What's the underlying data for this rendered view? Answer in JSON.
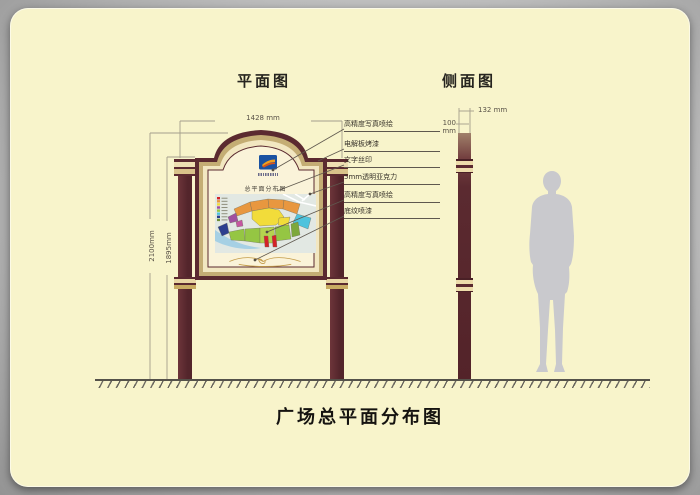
{
  "front_view": {
    "title": "平面图",
    "dim_width": "1428 mm",
    "dim_total_height": "2100mm",
    "dim_post_height": "1895mm",
    "panel_subtitle": "总平面分布图",
    "callouts": [
      {
        "label": "高精度写真喷绘"
      },
      {
        "label": "电解板烤漆"
      },
      {
        "label": "文字丝印"
      },
      {
        "label": "5mm透明亚克力"
      },
      {
        "label": "高精度写真喷绘"
      },
      {
        "label": "底纹喷漆"
      }
    ]
  },
  "side_view": {
    "title": "侧面图",
    "dim_depth": "132 mm",
    "dim_width": "100 mm"
  },
  "footer": {
    "title": "广场总平面分布图"
  },
  "colors": {
    "card_bg": "#f8f4cb",
    "maroon": "#5b2a30",
    "frame_tan": "#c4ad74",
    "frame_cream": "#f2e7c1",
    "panel_bg": "#faf3d9",
    "gold_band": "#d9c28a",
    "silhouette": "#c9c9cd",
    "logo_blue": "#1a52a2",
    "map_legend": [
      "#d42328",
      "#e8973f",
      "#f2dc3a",
      "#a04fa0",
      "#95c643",
      "#4fc3dd",
      "#2c3f8f",
      "#6f8f35"
    ]
  }
}
